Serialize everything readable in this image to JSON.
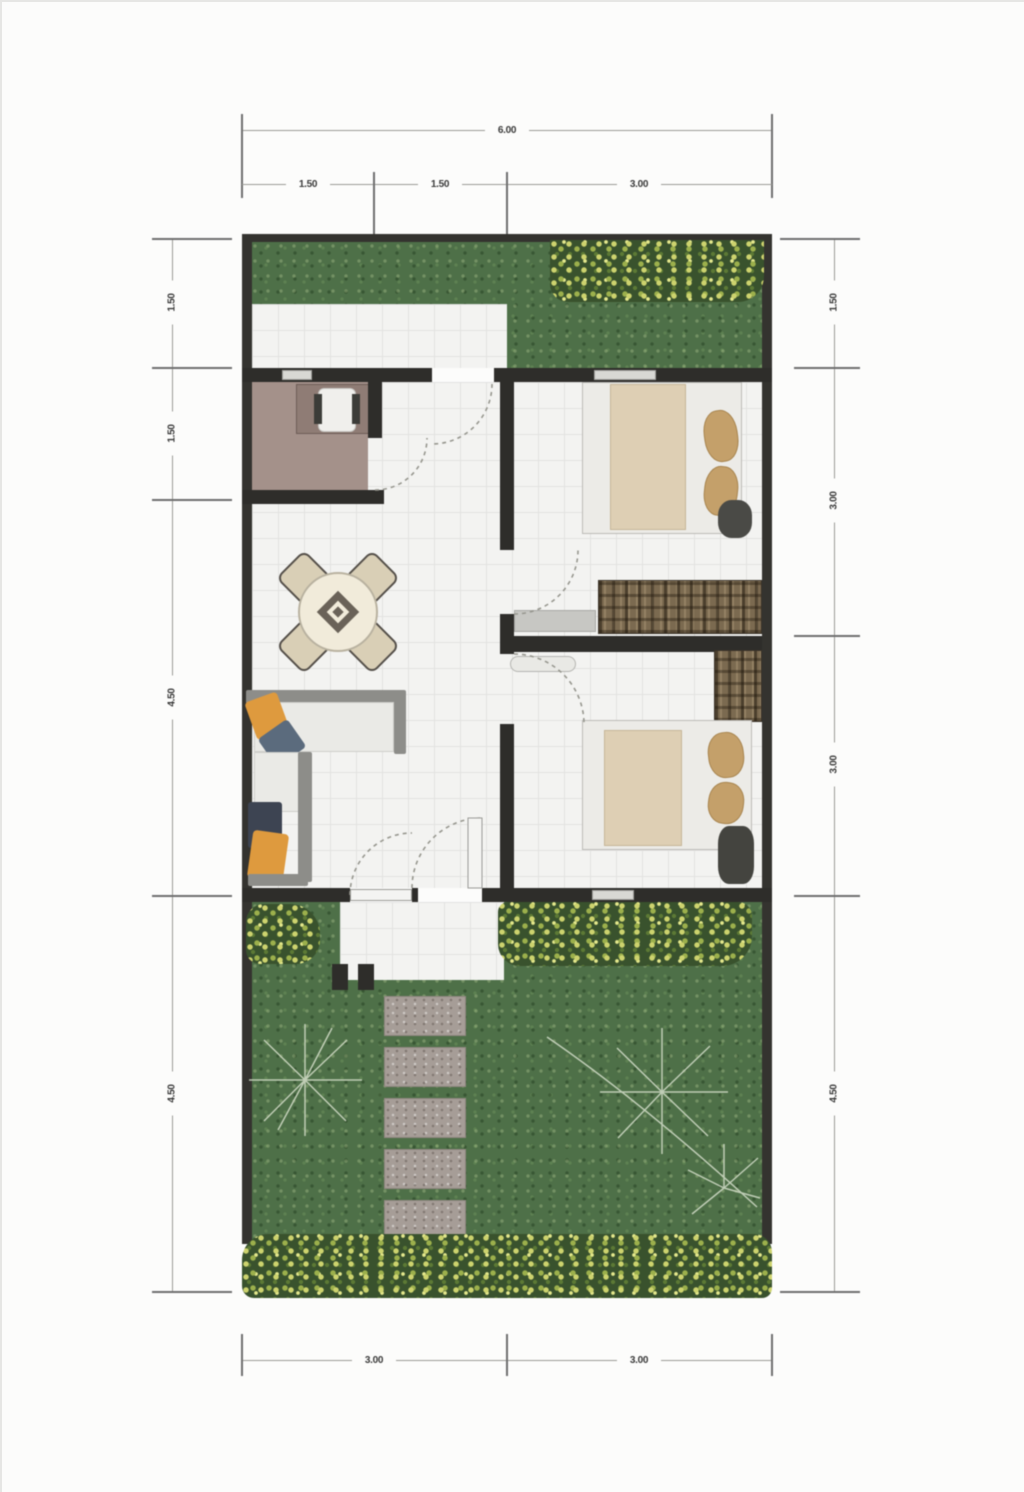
{
  "palette": {
    "grass": "#4e7048",
    "bush_foliage": "#39522d",
    "bush_flower": "#cdd36e",
    "wall": "#2e2d2a",
    "floor_tile": "#f3f3f1",
    "bathroom_floor": "#a4918a",
    "mattress_cream": "#decfb4",
    "pillow_tan": "#c4a06a",
    "wardrobe_brown": "#7b6a50",
    "sofa_orange": "#de9a3e",
    "sofa_navy": "#3d4452",
    "paver_gray": "#a69d97",
    "dimension_line": "#9b9b97",
    "dimension_text": "#3b3b3b"
  },
  "dimensions": {
    "top": {
      "total": "6.00",
      "segments": [
        "1.50",
        "1.50",
        "3.00"
      ]
    },
    "bottom": {
      "segments": [
        "3.00",
        "3.00"
      ]
    },
    "left": {
      "segments": [
        "1.50",
        "1.50",
        "4.50",
        "4.50"
      ]
    },
    "right": {
      "segments": [
        "1.50",
        "3.00",
        "3.00",
        "4.50"
      ]
    }
  },
  "furniture_icons": {
    "dining_set": "round-table-with-four-chairs",
    "living_sofa": "l-shaped-sofa-with-cushions",
    "beds": "bed-with-bolster-pillows",
    "wardrobe": "striped-wardrobe-cabinet",
    "desk_room": "desk-with-chair",
    "doors": "dashed-quarter-circle-swing",
    "garden_path": "stepping-stone-pavers",
    "planting": "flower-bush-border"
  }
}
